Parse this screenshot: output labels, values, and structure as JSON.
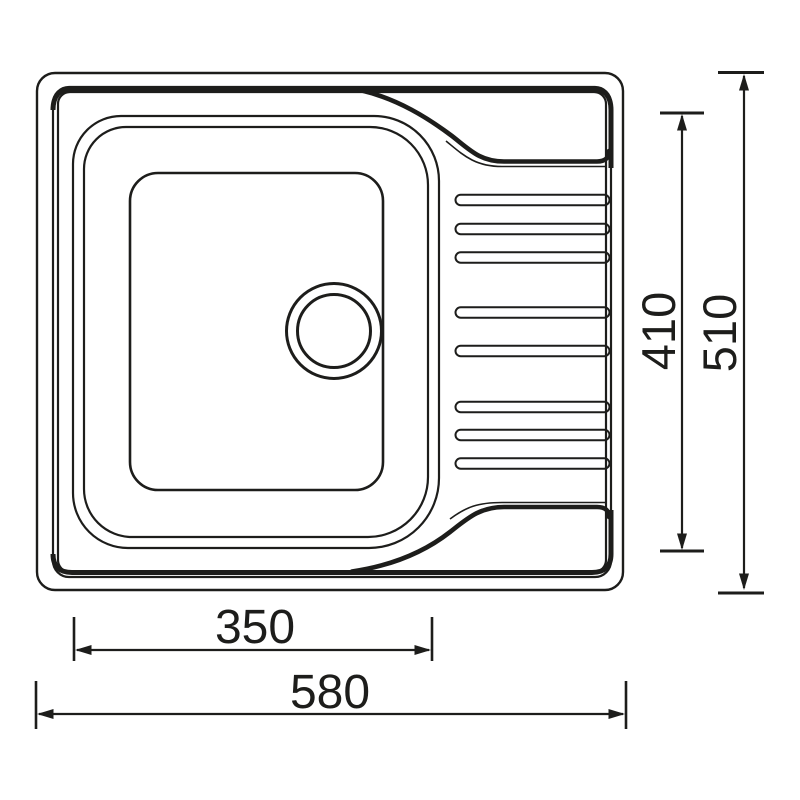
{
  "drawing": {
    "dimensions": {
      "bowl_width": "350",
      "overall_width": "580",
      "inner_depth": "410",
      "overall_depth": "510"
    }
  },
  "colors": {
    "line": "#1d1d1b",
    "background": "#ffffff"
  }
}
